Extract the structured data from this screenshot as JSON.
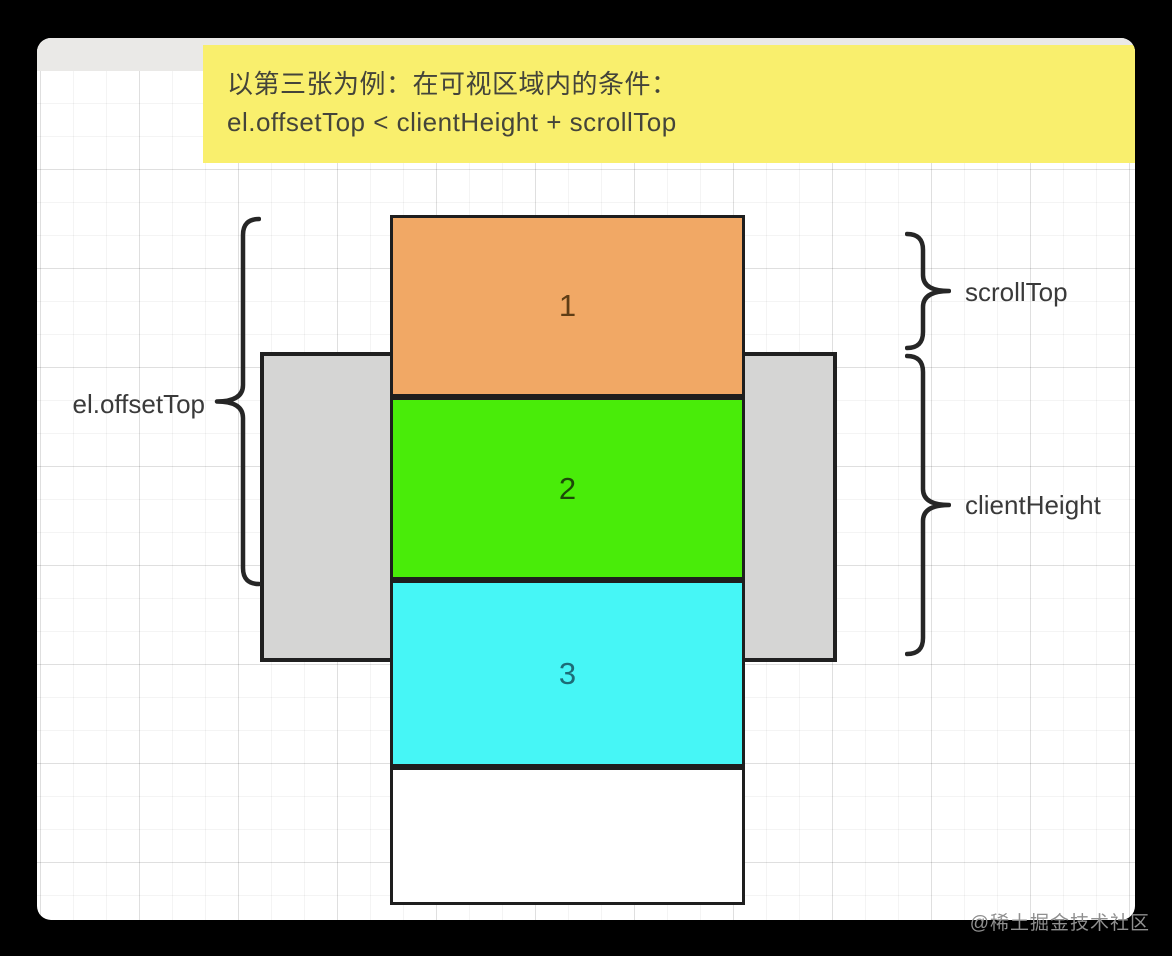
{
  "banner": {
    "line1": "以第三张为例：在可视区域内的条件：",
    "line2": "el.offsetTop < clientHeight  + scrollTop",
    "bg_color": "#f9ef6d",
    "text_color": "#44443a"
  },
  "diagram": {
    "boxes": [
      {
        "label": "1",
        "fill": "#f1a865",
        "label_color": "#5f3d15"
      },
      {
        "label": "2",
        "fill": "#49ec09",
        "label_color": "#1c4a08"
      },
      {
        "label": "3",
        "fill": "#46f6f6",
        "label_color": "#1d6c77"
      },
      {
        "label": "",
        "fill": "#ffffff",
        "label_color": "#333333"
      }
    ],
    "viewport_fill": "#d5d5d4",
    "labels": {
      "offset_top": "el.offsetTop",
      "scroll_top": "scrollTop",
      "client_height": "clientHeight"
    },
    "brace_color": "#262626"
  },
  "watermark": {
    "text": "@稀土掘金技术社区",
    "color": "#8f8f8f"
  }
}
